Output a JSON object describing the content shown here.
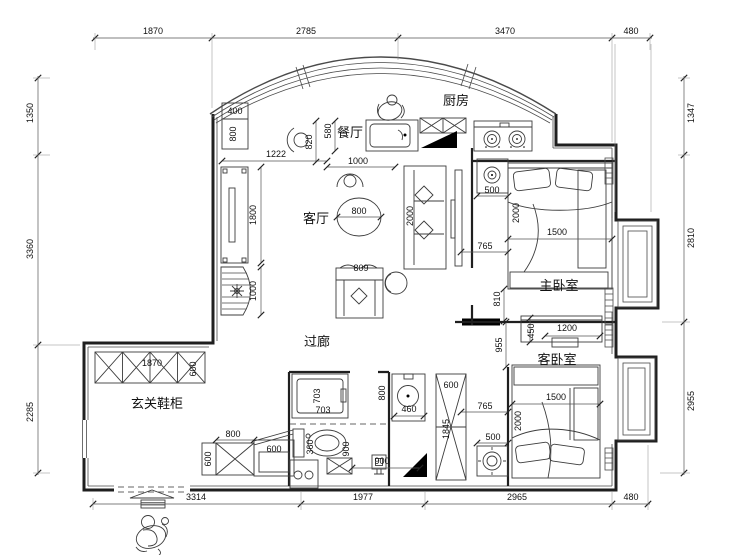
{
  "rooms": {
    "kitchen": "厨房",
    "dining": "餐厅",
    "living": "客厅",
    "master_bedroom": "主卧室",
    "guest_bedroom": "客卧室",
    "corridor": "过廊",
    "entrance_shoe_cabinet": "玄关鞋柜"
  },
  "dims": {
    "top": [
      "1870",
      "2785",
      "3470",
      "480"
    ],
    "left": [
      "1350",
      "3360",
      "2285"
    ],
    "right": [
      "1347",
      "2810",
      "2955"
    ],
    "bottom": [
      "3314",
      "1977",
      "2965",
      "480"
    ]
  },
  "d": {
    "v360": "360",
    "v400": "400",
    "v450": "450",
    "v460": "460",
    "v500": "500",
    "v580": "580",
    "v600": "600",
    "v703": "703",
    "v765": "765",
    "v800": "800",
    "v809": "809",
    "v810": "810",
    "v820": "820",
    "v900": "900",
    "v955": "955",
    "v1000": "1000",
    "v1200": "1200",
    "v1222": "1222",
    "v1500": "1500",
    "v1800": "1800",
    "v1845": "1845",
    "v1870": "1870",
    "v2000": "2000"
  },
  "colors": {
    "line": "#1f1f1f",
    "background": "#ffffff",
    "wall_fill": "#000000"
  }
}
